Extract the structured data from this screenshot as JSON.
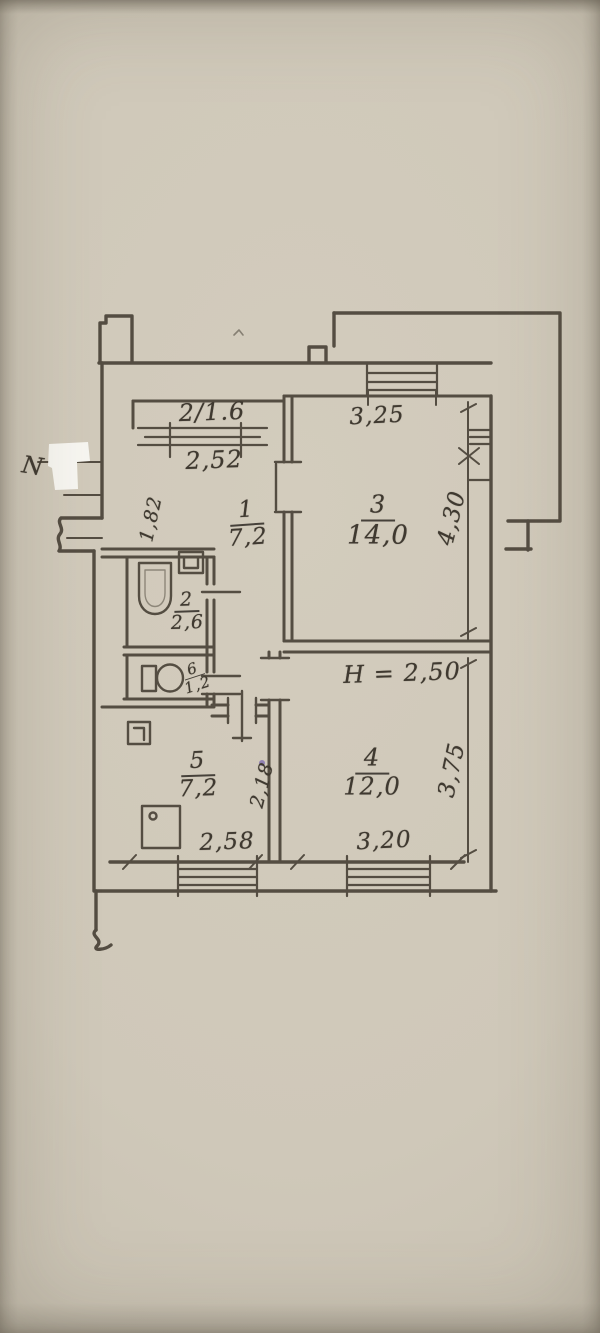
{
  "colors": {
    "paper": "#cfc8b9",
    "ink": "#4a4338",
    "correction_patch": "#fbfaf6",
    "ink_dot": "#7b68b0"
  },
  "north_label": "N",
  "rooms": {
    "balcony": {
      "label": "2/1.6",
      "width": "2,52"
    },
    "hall": {
      "number": "1",
      "area": "7,2",
      "width": "1,82"
    },
    "bathroom": {
      "number": "2",
      "area": "2,6"
    },
    "living_room": {
      "number": "3",
      "area": "14,0",
      "width": "3,25",
      "depth": "4,30"
    },
    "bedroom": {
      "number": "4",
      "area": "12,0",
      "width": "3,20",
      "depth": "3,75",
      "ceiling_height": "H = 2,50"
    },
    "kitchen": {
      "number": "5",
      "area": "7,2",
      "width": "2,58",
      "depth": "2,18"
    },
    "wc": {
      "number": "6",
      "area": "1,2"
    }
  }
}
